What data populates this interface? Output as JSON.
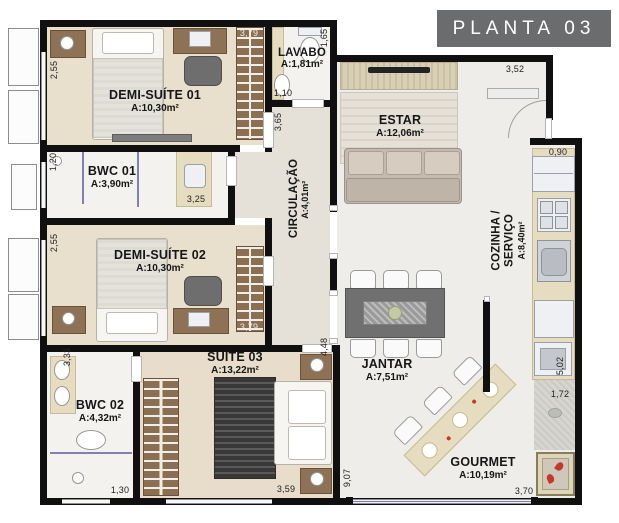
{
  "title": "PLANTA 03",
  "colors": {
    "wall": "#101010",
    "floor_warm": "#e9dfcd",
    "floor_light": "#f3f2ef",
    "floor_social": "#efede9",
    "wood": "#8d7256",
    "accent_red": "#c0392b",
    "glass": "#8080b5",
    "title_bg": "#6b6c6e"
  },
  "rooms": [
    {
      "id": "demi-suite-01",
      "name": "DEMI-SUÍTE 01",
      "area": "A:10,30m²"
    },
    {
      "id": "lavabo",
      "name": "LAVABO",
      "area": "A:1,81m²"
    },
    {
      "id": "estar",
      "name": "ESTAR",
      "area": "A:12,06m²"
    },
    {
      "id": "bwc-01",
      "name": "BWC 01",
      "area": "A:3,90m²"
    },
    {
      "id": "circulacao",
      "name": "CIRCULAÇÃO",
      "area": "A:4,01m²"
    },
    {
      "id": "cozinha-servico",
      "name": "COZINHA / SERVIÇO",
      "area": "A:8,40m²"
    },
    {
      "id": "demi-suite-02",
      "name": "DEMI-SUÍTE 02",
      "area": "A:10,30m²"
    },
    {
      "id": "bwc-02",
      "name": "BWC 02",
      "area": "A:4,32m²"
    },
    {
      "id": "suite-03",
      "name": "SUÍTE 03",
      "area": "A:13,22m²"
    },
    {
      "id": "jantar",
      "name": "JANTAR",
      "area": "A:7,51m²"
    },
    {
      "id": "gourmet",
      "name": "GOURMET",
      "area": "A:10,19m²"
    }
  ],
  "dims": [
    {
      "v": "2,55"
    },
    {
      "v": "3,79"
    },
    {
      "v": "1,65"
    },
    {
      "v": "1,10"
    },
    {
      "v": "3,65"
    },
    {
      "v": "1,20"
    },
    {
      "v": "3,25"
    },
    {
      "v": "2,55"
    },
    {
      "v": "3,79"
    },
    {
      "v": "3,33"
    },
    {
      "v": "1,30"
    },
    {
      "v": "4,48"
    },
    {
      "v": "3,59"
    },
    {
      "v": "9,07"
    },
    {
      "v": "3,52"
    },
    {
      "v": "0,90"
    },
    {
      "v": "5,02"
    },
    {
      "v": "1,72"
    },
    {
      "v": "3,70"
    }
  ]
}
